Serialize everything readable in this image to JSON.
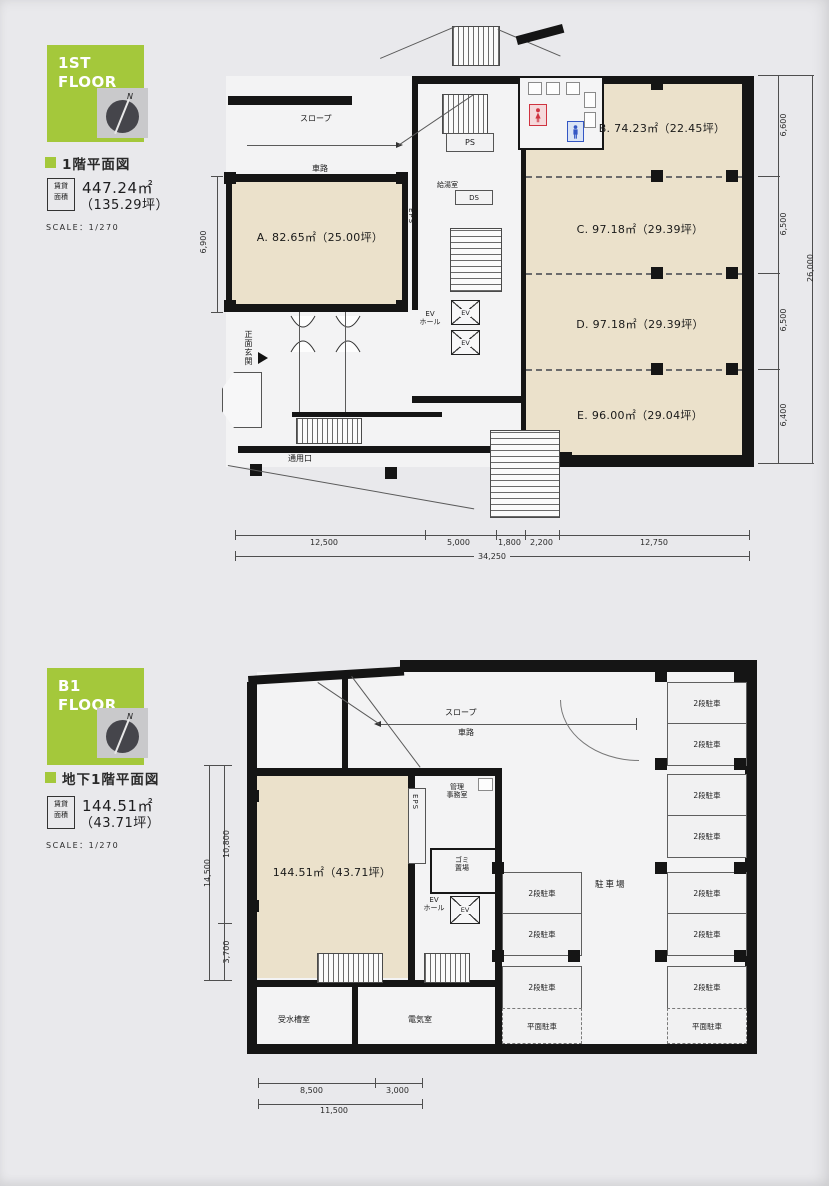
{
  "colors": {
    "badge_green": "#a4c83b",
    "beige": "#ebe1cb",
    "wall": "#151515",
    "female_red": "#cf3340",
    "male_blue": "#3356c4"
  },
  "f1": {
    "badge_l1": "1ST",
    "badge_l2": "FLOOR",
    "compass_n": "N",
    "heading": "1階平面図",
    "lease_l1": "賃貸",
    "lease_l2": "面積",
    "area_value": "447.24㎡",
    "area_tsubo": "（135.29坪）",
    "scale": "SCALE：1/270",
    "rooms": {
      "a": "A. 82.65㎡（25.00坪）",
      "b": "B. 74.23㎡（22.45坪）",
      "c": "C. 97.18㎡（29.39坪）",
      "d": "D. 97.18㎡（29.39坪）",
      "e": "E. 96.00㎡（29.04坪）"
    },
    "labels": {
      "slope": "スロープ",
      "driveway": "車路",
      "ps": "PS",
      "kyuto": "給湯室",
      "ds": "DS",
      "eps": "EPS",
      "ev_hall_1": "EV",
      "ev_hall_2": "ホール",
      "ev": "EV",
      "main_entrance": "正面玄関",
      "service_entrance": "通用口"
    },
    "dims": {
      "bottom": [
        "12,500",
        "5,000",
        "1,800",
        "2,200",
        "12,750"
      ],
      "bottom_total": "34,250",
      "right": [
        "6,600",
        "6,500",
        "6,500",
        "6,400"
      ],
      "right_total": "26,000",
      "left": "6,900"
    }
  },
  "b1": {
    "badge_l1": "B1",
    "badge_l2": "FLOOR",
    "compass_n": "N",
    "heading": "地下1階平面図",
    "lease_l1": "賃貸",
    "lease_l2": "面積",
    "area_value": "144.51㎡",
    "area_tsubo": "（43.71坪）",
    "scale": "SCALE：1/270",
    "room_label": "144.51㎡（43.71坪）",
    "labels": {
      "slope": "スロープ",
      "driveway": "車路",
      "mgmt_1": "管理",
      "mgmt_2": "事務室",
      "trash_1": "ゴミ",
      "trash_2": "置場",
      "eps": "EPS",
      "ev_hall_1": "EV",
      "ev_hall_2": "ホール",
      "ev": "EV",
      "water_tank": "受水槽室",
      "electrical": "電気室",
      "parking_lot": "駐車場"
    },
    "parking": {
      "left": [
        "2段駐車",
        "2段駐車",
        "2段駐車",
        "平面駐車"
      ],
      "right": [
        "2段駐車",
        "2段駐車",
        "2段駐車",
        "2段駐車",
        "2段駐車",
        "2段駐車",
        "2段駐車",
        "平面駐車"
      ]
    },
    "dims": {
      "bottom": [
        "8,500",
        "3,000"
      ],
      "bottom_total": "11,500",
      "left": [
        "10,800",
        "3,700"
      ],
      "left_total": "14,500"
    }
  }
}
